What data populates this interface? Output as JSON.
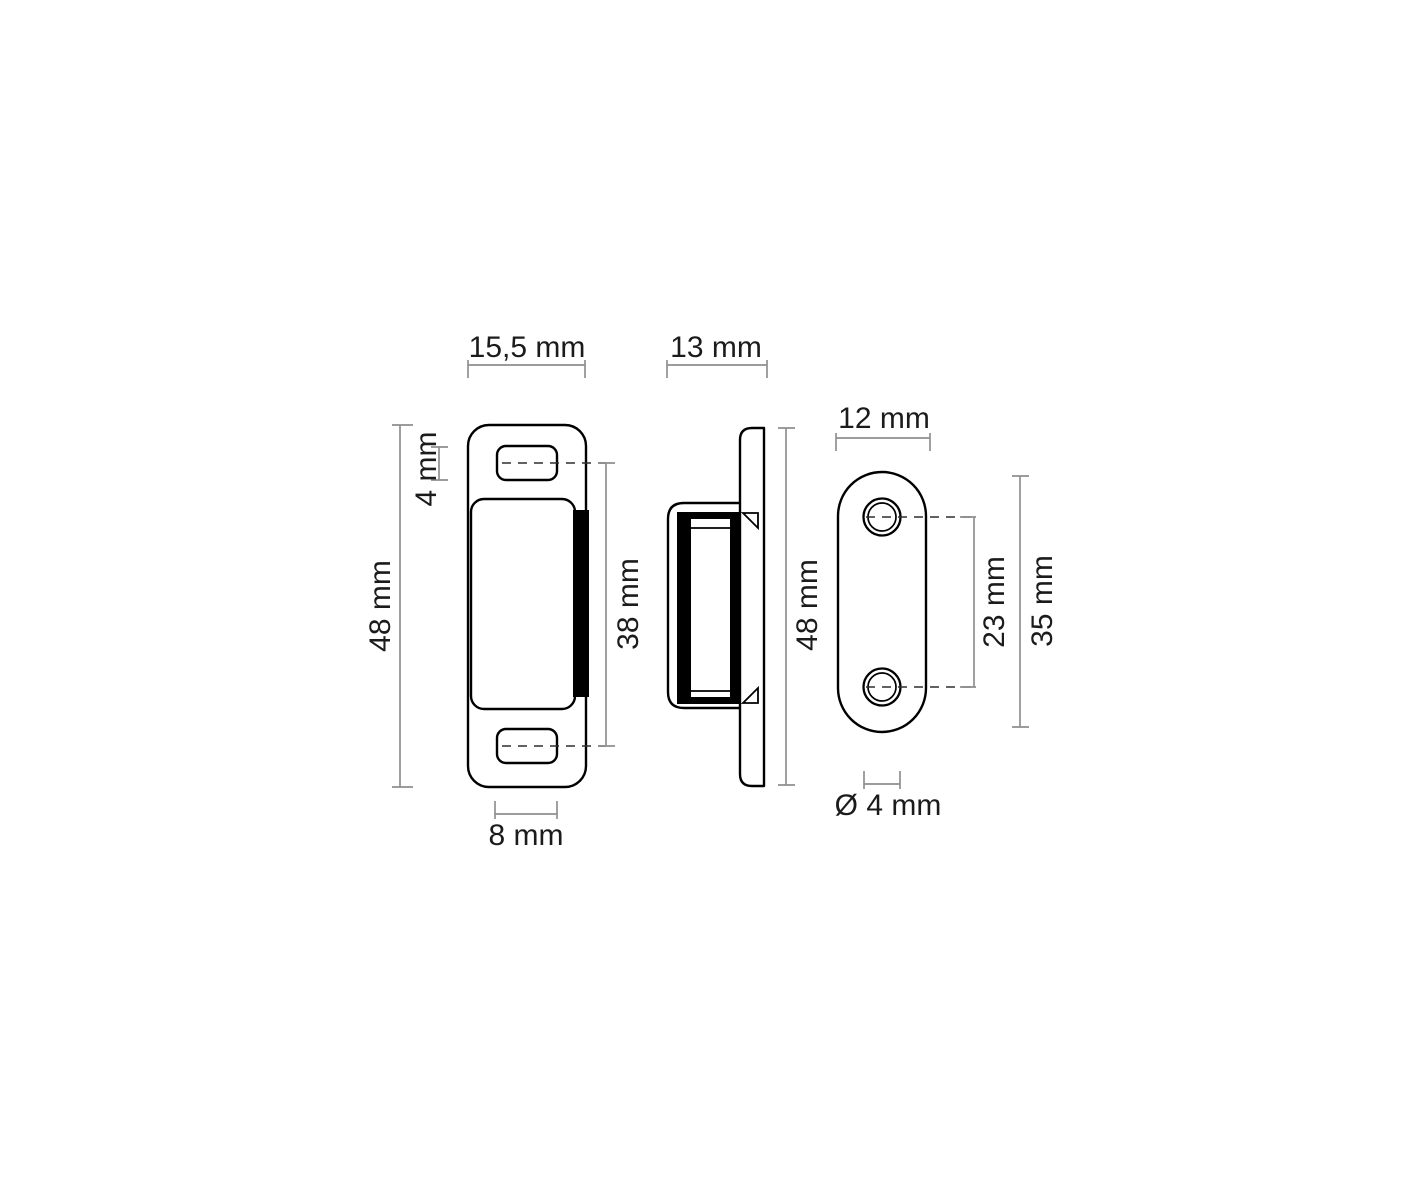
{
  "drawing": {
    "kind": "technical-dimension-drawing",
    "subject": "magnetic catch with counter plate, three orthographic views"
  },
  "colors": {
    "outline": "#000000",
    "dimension_lines": "#8f8f8f",
    "text": "#1b1b1b",
    "background": "#ffffff",
    "magnet_fill": "#000000"
  },
  "views": {
    "front": {
      "name": "front view of magnetic catch",
      "labels": {
        "width": "15,5 mm",
        "slot_height": "4 mm",
        "total_height": "48 mm",
        "body_height": "38 mm",
        "slot_width": "8 mm"
      }
    },
    "side": {
      "name": "side view of magnetic catch",
      "labels": {
        "depth": "13 mm",
        "total_height": "48 mm"
      }
    },
    "counter_plate": {
      "name": "counter plate with two screw holes",
      "labels": {
        "width": "12 mm",
        "hole_spacing": "23 mm",
        "height": "35 mm",
        "hole_diameter": "Ø 4 mm"
      }
    }
  }
}
